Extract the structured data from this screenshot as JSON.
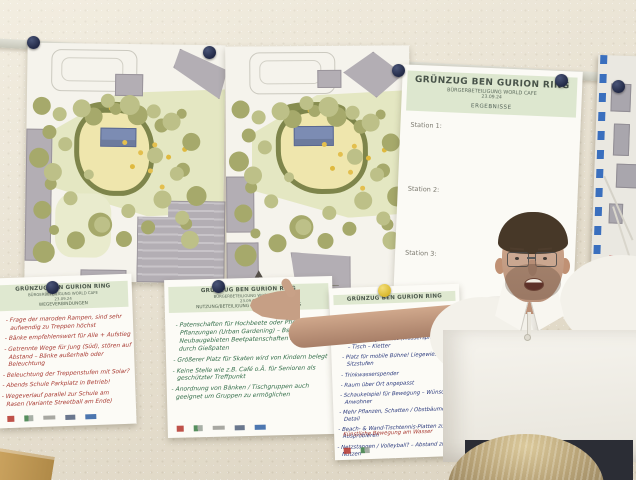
{
  "results_poster": {
    "title": "GRÜNZUG BEN GURION RING",
    "subtitle": "BÜRGERBETEILIGUNG WORLD CAFE",
    "date": "23.09.24",
    "topic": "ERGEBNISSE",
    "stations": [
      "Station 1:",
      "Station 2:",
      "Station 3:"
    ]
  },
  "flipcharts": {
    "left": {
      "title": "GRÜNZUG BEN GURION RING",
      "subtitle": "BÜRGERBETEILIGUNG WORLD CAFE",
      "date": "23.09.24",
      "topic": "WEGEVERBINDUNGEN",
      "notes": [
        "Frage der maroden Rampen, sind sehr aufwendig zu Treppen höchst",
        "Bänke empfehlenswert für Alle + Aufstieg",
        "Getrennte Wege für Jung (Süd), stören auf Abstand – Bänke außerhalb oder Beleuchtung",
        "Beleuchtung der Treppenstufen mit Solar?",
        "Abends Schule Parkplatz in Betrieb!",
        "Wegeverlauf parallel zur Schule am Rasen (Variante Streetball am Ende)"
      ]
    },
    "middle": {
      "title": "GRÜNZUG BEN GURION RING",
      "subtitle": "BÜRGERBETEILIGUNG WORLD CAFE",
      "date": "23.09.24",
      "topic": "NUTZUNG/BETEILIGUNG KONFLIKTVERMEIDUNG",
      "notes": [
        "Patenschaften für Hochbeete oder Pflege für Pflanzungen (Urban Gardening) – Bsp. bei Neubaugebieten Beetpatenschaften in Begleitung durch Gießpaten",
        "Größerer Platz für Skaten wird von Kindern belegt",
        "Keine Stelle wie z.B. Café o.Ä. für Senioren als geschützter Treffpunkt",
        "Anordnung von Bänken / Tischgruppen auch geeignet um Gruppen zu ermöglichen"
      ]
    },
    "right": {
      "title": "GRÜNZUG BEN GURION RING",
      "notes": [
        "Spielplatz gestaltet (Wasserspiel) – Beach – Tisch – Kletter",
        "Platz für mobile Bühne! Liegewiese + Sitzstufen",
        "Trinkwasserspender",
        "Raum über Ort angepasst",
        "Schaukelspiel für Bewegung – Wünsche – Anwohner",
        "Mehr Pflanzen, Schatten / Obstbäume im Detail",
        "Beach- & Wand-Tischtennis-Platten zum Ausprobieren",
        "Netzstangen / Volleyball? – Abstand zum Nutzen"
      ],
      "last_note": "Künstliche Bewegung am Wasser"
    }
  },
  "icons": {
    "pin": "round magnet pin",
    "partner_logo": "small colored logo block",
    "north_arrow": "plan north arrow",
    "map_border": "blue dashed map frame"
  },
  "colors": {
    "wall": "#ebe3d1",
    "rail": "#d3d3c7",
    "paper": "#fbfaf5",
    "header_band": "#dde7cf",
    "ink_red": "#a83a32",
    "ink_green": "#2f6b46",
    "ink_blue": "#2b3a7d",
    "pin_navy": "#2a3150",
    "pin_yellow": "#e7c93f",
    "plan_tree": "#a6a96b",
    "plan_lawn": "#e4e7c2",
    "plan_building": "#b3aeb4",
    "pavilion_blue": "#7c8cb3",
    "map_dash": "#3a6fbe",
    "polo_white": "#f3f1ea",
    "skin": "#c69f85",
    "pants": "#2b2d35"
  }
}
